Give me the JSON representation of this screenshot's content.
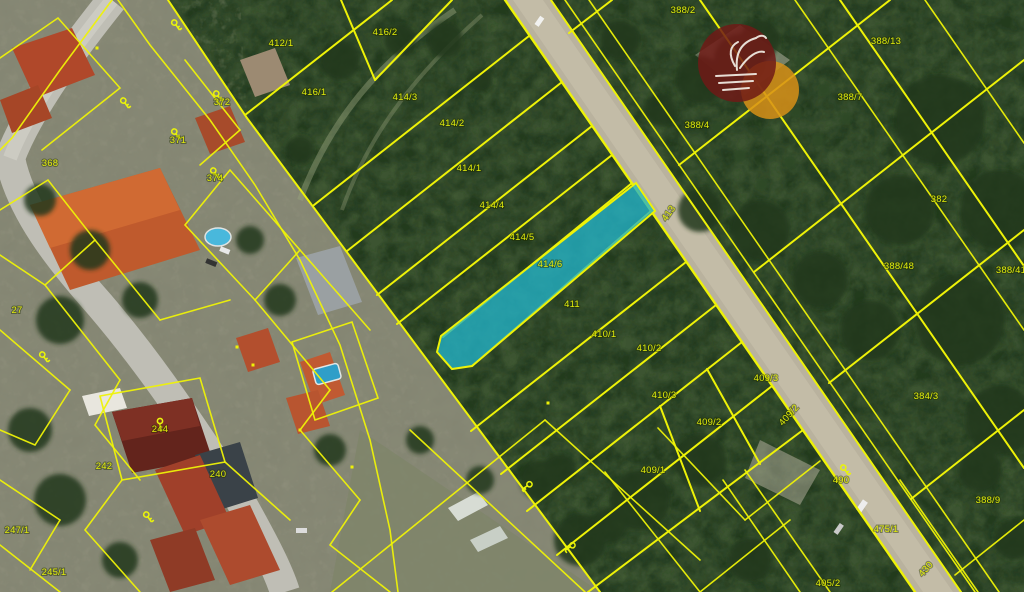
{
  "map": {
    "type": "cadastral-parcel-map",
    "style": {
      "parcel_line_color": "#eef207",
      "label_color": "#e0ea0c",
      "road_color": "#b9b29e",
      "field_color": "#3c5431"
    },
    "highlight": {
      "parcel_number": "414/6",
      "fill_color": "#23b4c9",
      "fill_opacity": "0.78"
    },
    "parcel_labels": [
      {
        "t": "412/1",
        "x": 281,
        "y": 46
      },
      {
        "t": "416/2",
        "x": 385,
        "y": 35
      },
      {
        "t": "416/1",
        "x": 314,
        "y": 95
      },
      {
        "t": "414/3",
        "x": 405,
        "y": 100
      },
      {
        "t": "414/2",
        "x": 452,
        "y": 126
      },
      {
        "t": "414/1",
        "x": 469,
        "y": 171
      },
      {
        "t": "414/4",
        "x": 492,
        "y": 208
      },
      {
        "t": "414/5",
        "x": 522,
        "y": 240
      },
      {
        "t": "414/6",
        "x": 550,
        "y": 267
      },
      {
        "t": "411",
        "x": 572,
        "y": 307
      },
      {
        "t": "410/1",
        "x": 604,
        "y": 337
      },
      {
        "t": "410/2",
        "x": 649,
        "y": 351
      },
      {
        "t": "410/3",
        "x": 664,
        "y": 398
      },
      {
        "t": "409/3",
        "x": 766,
        "y": 381
      },
      {
        "t": "409/2",
        "x": 709,
        "y": 425
      },
      {
        "t": "409/2",
        "x": 791,
        "y": 417,
        "rot": -48
      },
      {
        "t": "409/1",
        "x": 653,
        "y": 473
      },
      {
        "t": "413",
        "x": 671,
        "y": 215,
        "rot": -55
      },
      {
        "t": "388/2",
        "x": 683,
        "y": 13
      },
      {
        "t": "388/4",
        "x": 697,
        "y": 128
      },
      {
        "t": "388/13",
        "x": 886,
        "y": 44
      },
      {
        "t": "388/7",
        "x": 850,
        "y": 100
      },
      {
        "t": "382",
        "x": 939,
        "y": 202
      },
      {
        "t": "388/48",
        "x": 899,
        "y": 269
      },
      {
        "t": "388/41",
        "x": 1011,
        "y": 273
      },
      {
        "t": "384/3",
        "x": 926,
        "y": 399
      },
      {
        "t": "388/9",
        "x": 988,
        "y": 503
      },
      {
        "t": "475/1",
        "x": 886,
        "y": 532
      },
      {
        "t": "490",
        "x": 841,
        "y": 483
      },
      {
        "t": "430",
        "x": 928,
        "y": 571,
        "rot": -48
      },
      {
        "t": "405/2",
        "x": 828,
        "y": 586
      },
      {
        "t": "372",
        "x": 222,
        "y": 105
      },
      {
        "t": "371",
        "x": 178,
        "y": 143
      },
      {
        "t": "374",
        "x": 215,
        "y": 181
      },
      {
        "t": "368",
        "x": 50,
        "y": 166
      },
      {
        "t": "27",
        "x": 17,
        "y": 313
      },
      {
        "t": "244",
        "x": 160,
        "y": 432
      },
      {
        "t": "240",
        "x": 218,
        "y": 477
      },
      {
        "t": "242",
        "x": 104,
        "y": 469
      },
      {
        "t": "247/1",
        "x": 17,
        "y": 533
      },
      {
        "t": "245/1",
        "x": 54,
        "y": 575
      }
    ],
    "building_key_icons": [
      {
        "x": 176,
        "y": 25,
        "rot": -35
      },
      {
        "x": 125,
        "y": 103,
        "rot": -35
      },
      {
        "x": 218,
        "y": 96,
        "rot": -35
      },
      {
        "x": 176,
        "y": 134,
        "rot": -35
      },
      {
        "x": 215,
        "y": 173,
        "rot": -35
      },
      {
        "x": 44,
        "y": 357,
        "rot": -35
      },
      {
        "x": 148,
        "y": 517,
        "rot": -35
      },
      {
        "x": 845,
        "y": 470,
        "rot": -35
      },
      {
        "x": 527,
        "y": 486,
        "rot": 55
      },
      {
        "x": 570,
        "y": 547,
        "rot": 55
      },
      {
        "x": 160,
        "y": 424,
        "rot": 0
      }
    ],
    "centroid_dots": [
      {
        "x": 253,
        "y": 365
      },
      {
        "x": 352,
        "y": 467
      },
      {
        "x": 548,
        "y": 403
      },
      {
        "x": 97,
        "y": 48
      },
      {
        "x": 237,
        "y": 347
      },
      {
        "x": 300,
        "y": 430
      }
    ],
    "watermark": {
      "name": "realty-agency-logo",
      "primary_color": "#6e1a16",
      "secondary_color": "#d89018",
      "glyph": "sailboat"
    }
  }
}
